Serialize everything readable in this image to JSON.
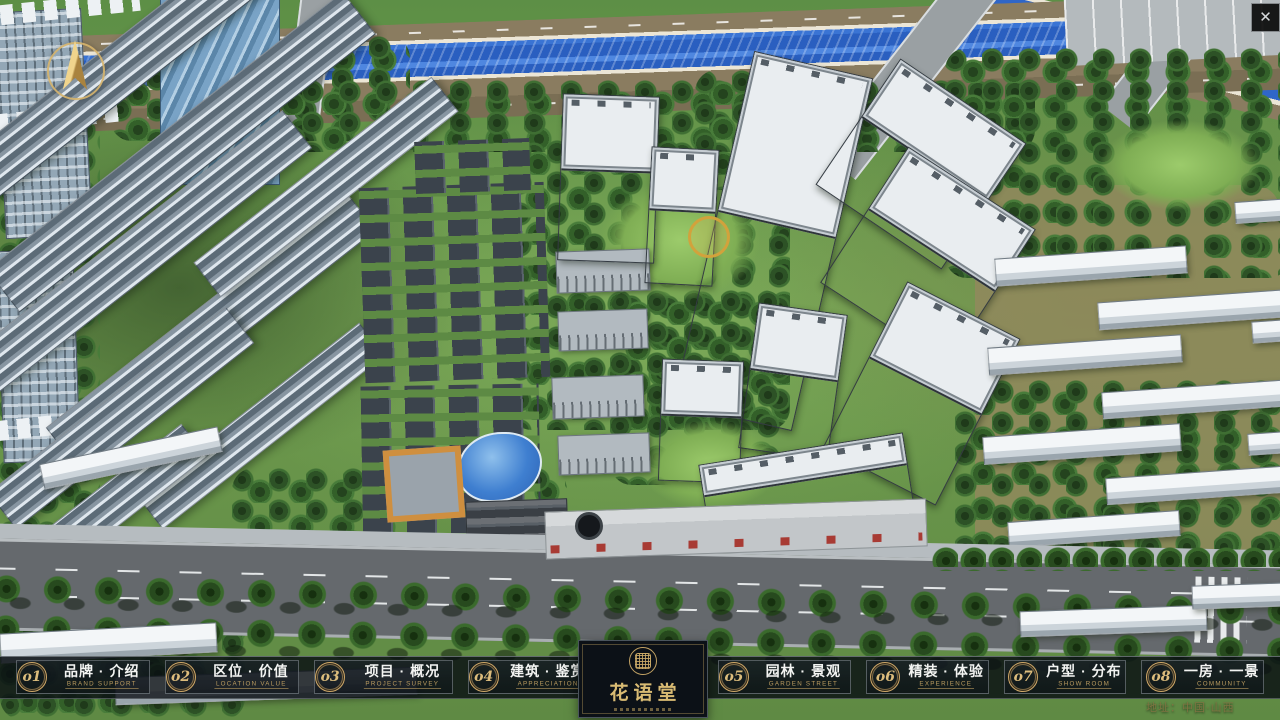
{
  "titlebar": {
    "close_icon": "✕"
  },
  "nav": {
    "items": [
      {
        "num": "o1",
        "zh": "品牌 · 介绍",
        "en": "BRAND SUPPORT"
      },
      {
        "num": "o2",
        "zh": "区位 · 价值",
        "en": "LOCATION VALUE"
      },
      {
        "num": "o3",
        "zh": "项目 · 概况",
        "en": "PROJECT SURVEY"
      },
      {
        "num": "o4",
        "zh": "建筑 · 鉴赏",
        "en": "APPRECIATION"
      },
      {
        "num": "o5",
        "zh": "园林 · 景观",
        "en": "GARDEN STREET"
      },
      {
        "num": "o6",
        "zh": "精装 · 体验",
        "en": "EXPERIENCE"
      },
      {
        "num": "o7",
        "zh": "户型 · 分布",
        "en": "SHOW ROOM"
      },
      {
        "num": "o8",
        "zh": "一房 · 一景",
        "en": "COMMUNITY"
      }
    ]
  },
  "logo": {
    "title": "花语堂"
  },
  "footer": {
    "address": "地址：中国·山西"
  },
  "colors": {
    "gold": "#c9a86a",
    "bar_bg": "rgba(8,13,18,0.82)",
    "accent_text": "#bb9c60"
  }
}
